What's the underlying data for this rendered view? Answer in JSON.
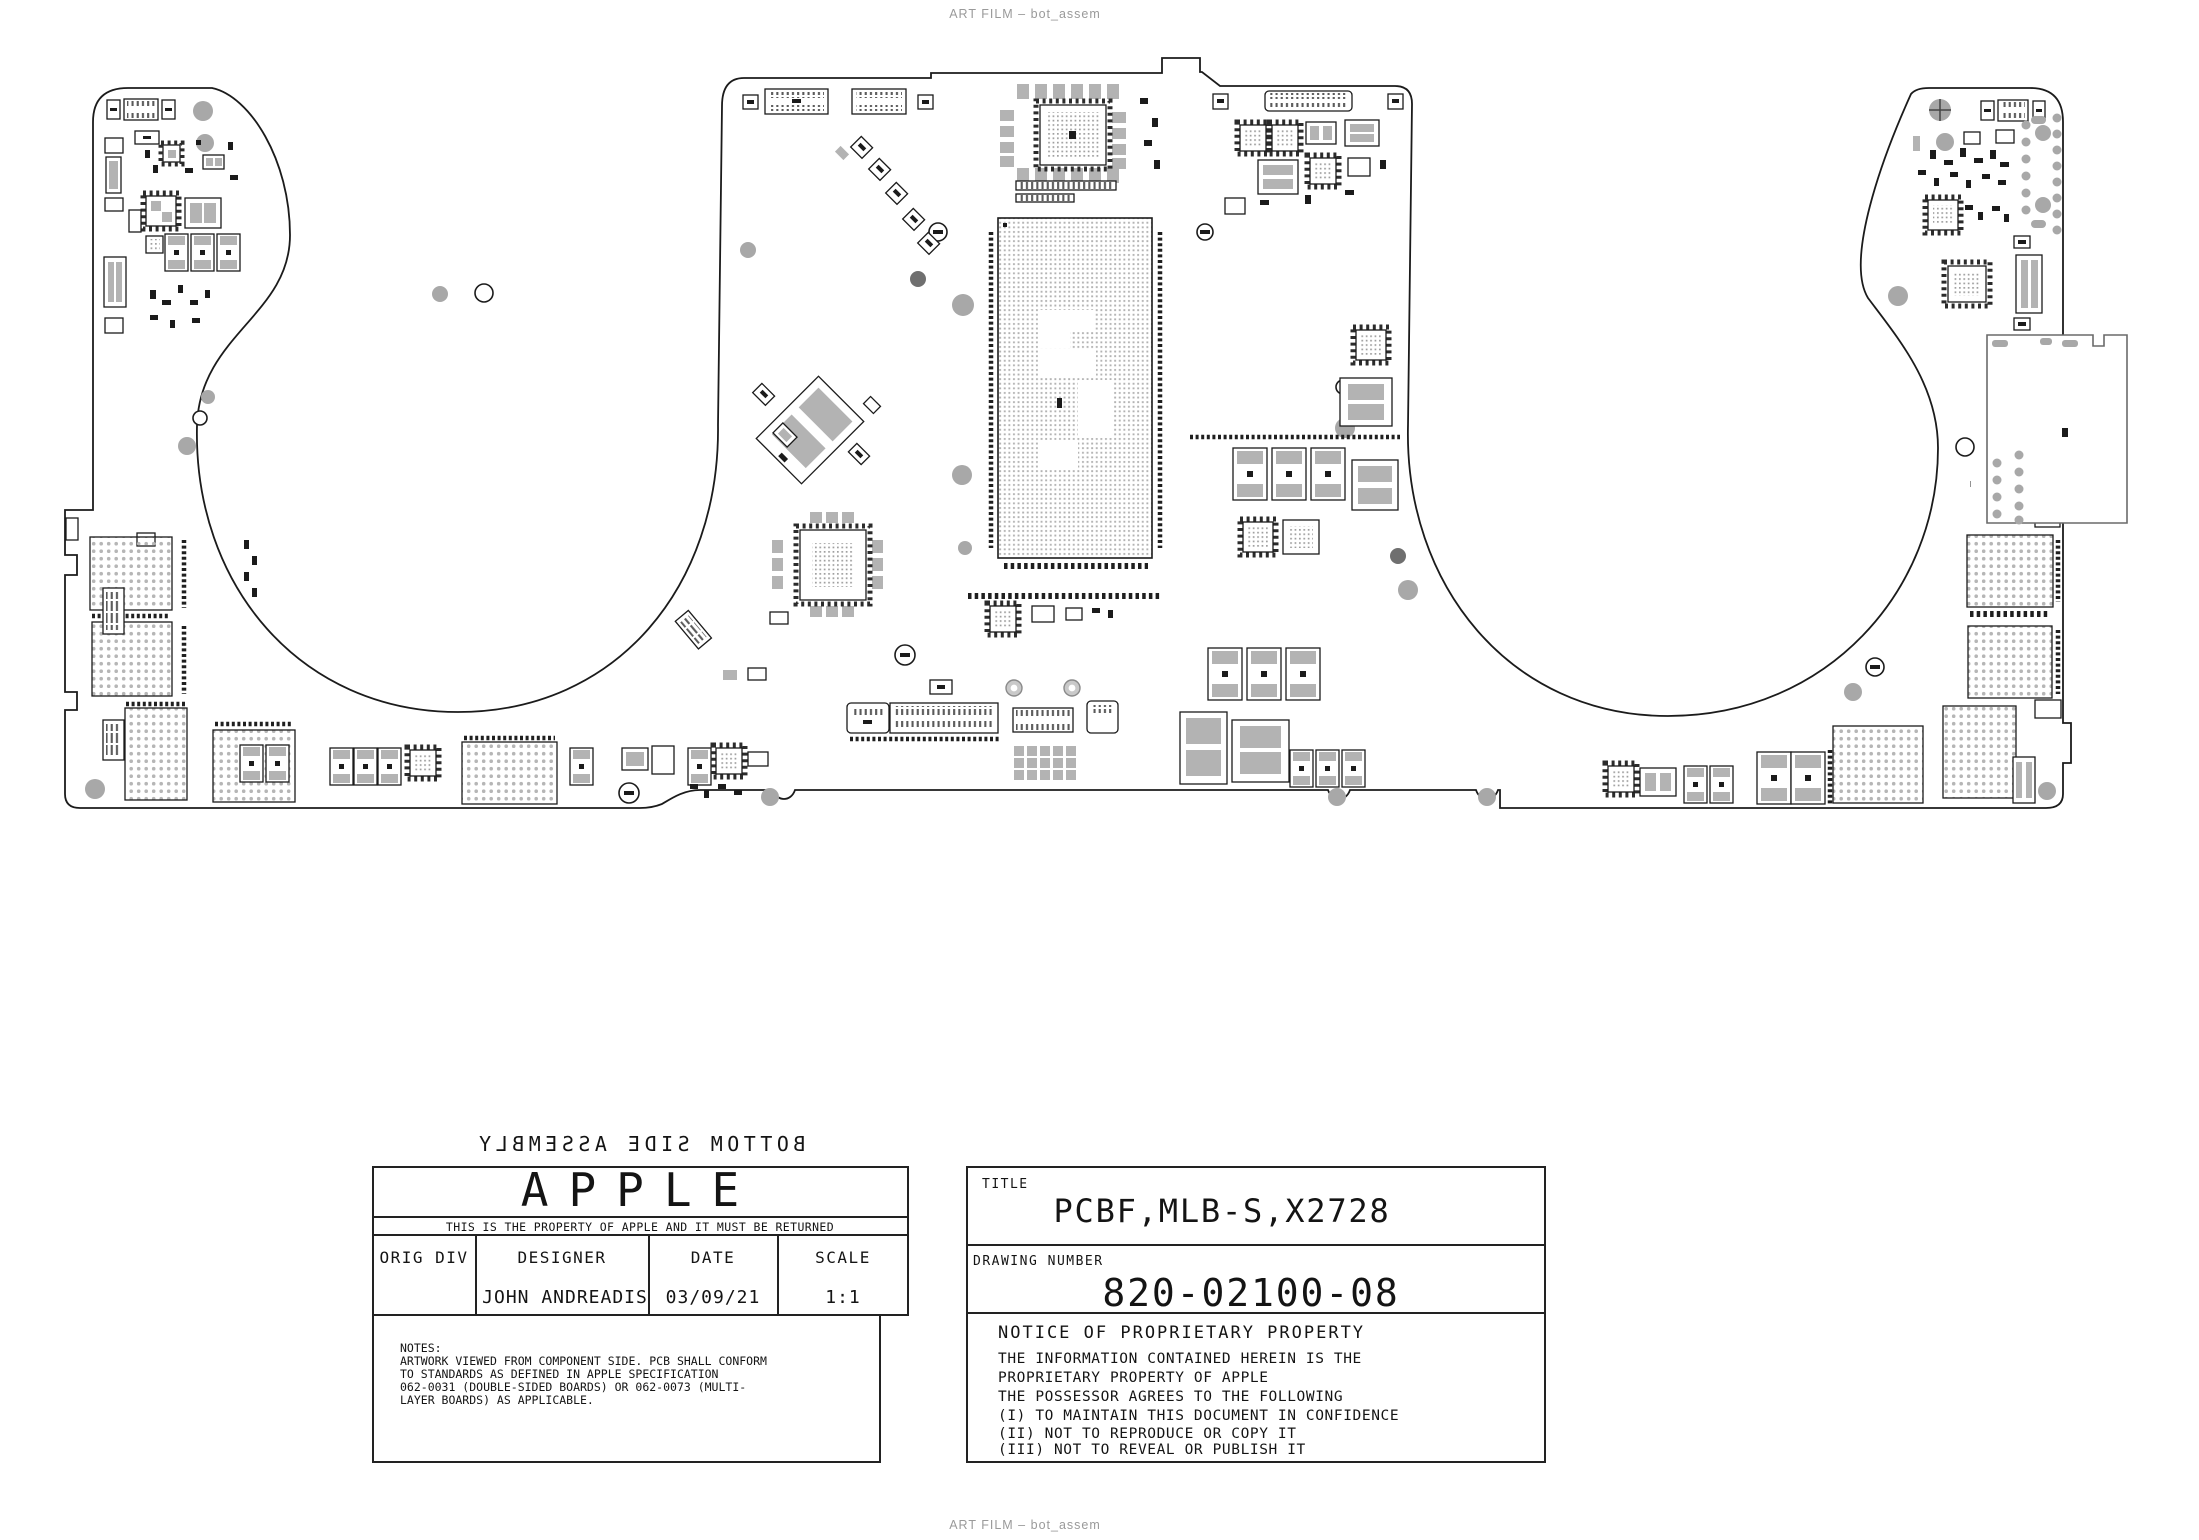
{
  "page": {
    "art_film_label": "ART FILM – bot_assem"
  },
  "board": {
    "assembly_label": "BOTTOM SIDE ASSEMBLY",
    "view_note": "artwork viewed from component side (text mirrored)"
  },
  "title_block": {
    "company": "APPLE",
    "property_notice": "THIS IS THE PROPERTY OF APPLE AND IT MUST BE RETURNED",
    "orig_div_label": "ORIG DIV",
    "orig_div_value": "",
    "designer_label": "DESIGNER",
    "designer_value": "JOHN ANDREADIS",
    "date_label": "DATE",
    "date_value": "03/09/21",
    "scale_label": "SCALE",
    "scale_value": "1:1",
    "title_label": "TITLE",
    "title_value": "PCBF,MLB-S,X2728",
    "drawing_number_label": "DRAWING NUMBER",
    "drawing_number_value": "820-02100-08",
    "notes": [
      "NOTES:",
      "ARTWORK VIEWED FROM COMPONENT SIDE. PCB SHALL CONFORM",
      "TO STANDARDS AS DEFINED IN APPLE SPECIFICATION",
      "062-0031 (DOUBLE-SIDED BOARDS) OR 062-0073 (MULTI-",
      "LAYER BOARDS) AS APPLICABLE."
    ],
    "notice_title": "NOTICE OF PROPRIETARY PROPERTY",
    "notice_lines": [
      "THE INFORMATION CONTAINED HEREIN IS THE",
      "PROPRIETARY PROPERTY OF APPLE",
      "THE POSSESSOR AGREES TO THE FOLLOWING",
      "(I) TO MAINTAIN THIS DOCUMENT IN CONFIDENCE",
      "(II) NOT TO REPRODUCE OR COPY IT",
      "(III) NOT TO REVEAL OR PUBLISH IT"
    ]
  },
  "colors": {
    "board_stroke": "#1b1b1b",
    "pad_gray": "#b3b3b3",
    "hole_gray": "#a8a8a8",
    "label_gray": "#9a9a9a",
    "background": "#ffffff"
  }
}
